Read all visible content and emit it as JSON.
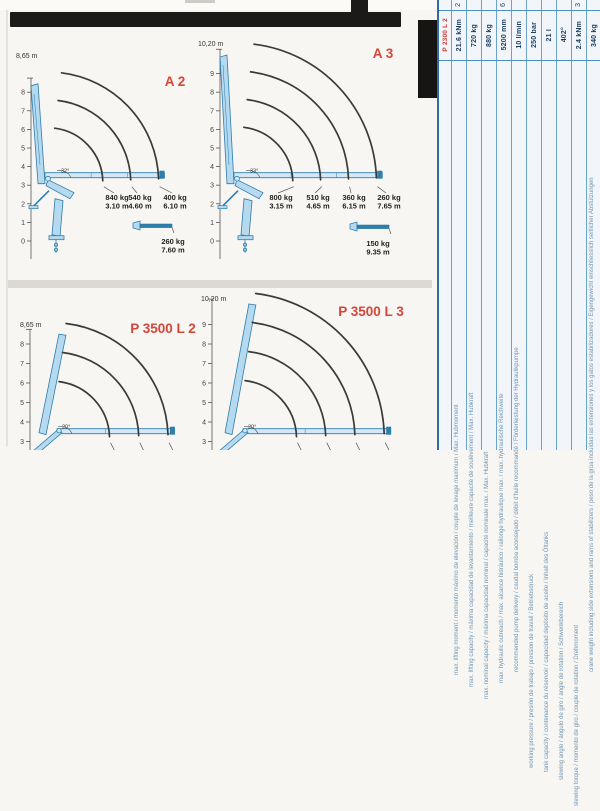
{
  "document": {
    "kind": "scanned crane load-diagram datasheet",
    "bg_color": "#f7f6f2"
  },
  "colors": {
    "arc": "#3a3a3a",
    "crane_fill": "#b5d9ee",
    "crane_fill_light": "#d3e8f4",
    "crane_stroke": "#2e7eae",
    "red": "#d6453a",
    "axis": "#555555",
    "load_text": "#1f1f1f",
    "table_line": "#4a90c4",
    "table_value": "#173b5e",
    "table_label": "#7096b6",
    "table_header_red": "#cc3a33"
  },
  "charts": [
    {
      "id": "a2",
      "type": "crane-load-diagram",
      "variant": "A",
      "title": "A 2",
      "max_height_label": "8,65 m",
      "y_ticks": [
        0,
        1,
        2,
        3,
        4,
        5,
        6,
        7,
        8
      ],
      "angle_label": "32°",
      "labels_visible": true,
      "loads": [
        {
          "load": "840 kg",
          "reach": "3.10 m",
          "reach_m": 3.1
        },
        {
          "load": "540 kg",
          "reach": "4.60 m",
          "reach_m": 4.6
        },
        {
          "load": "400 kg",
          "reach": "6.10 m",
          "reach_m": 6.1
        }
      ],
      "extension": {
        "load": "260 kg",
        "reach": "7.60 m"
      },
      "geom": {
        "axis_x": 31,
        "y0": 241,
        "unit": 18.6,
        "pivot_x": 48,
        "axis_top_m": 8.65,
        "title": {
          "x": 175,
          "y": 86
        },
        "top_label": {
          "x": 16,
          "y": 58
        },
        "label_row_y": 194,
        "label_centers": [
          117,
          140,
          175
        ],
        "ext_icon": {
          "x": 133,
          "y": 221
        },
        "ext_label": {
          "cx": 173,
          "y": 238
        }
      }
    },
    {
      "id": "a3",
      "type": "crane-load-diagram",
      "variant": "A",
      "title": "A 3",
      "max_height_label": "10,20 m",
      "y_ticks": [
        0,
        1,
        2,
        3,
        4,
        5,
        6,
        7,
        8,
        9
      ],
      "angle_label": "33°",
      "labels_visible": true,
      "loads": [
        {
          "load": "800 kg",
          "reach": "3.15 m",
          "reach_m": 3.15
        },
        {
          "load": "510 kg",
          "reach": "4.65 m",
          "reach_m": 4.65
        },
        {
          "load": "360 kg",
          "reach": "6.15 m",
          "reach_m": 6.15
        },
        {
          "load": "260 kg",
          "reach": "7.65 m",
          "reach_m": 7.65
        }
      ],
      "extension": {
        "load": "150 kg",
        "reach": "9.35 m"
      },
      "geom": {
        "axis_x": 220,
        "y0": 241,
        "unit": 18.6,
        "pivot_x": 237,
        "axis_top_m": 10.2,
        "title": {
          "x": 383,
          "y": 58
        },
        "top_label": {
          "x": 198,
          "y": 46
        },
        "label_row_y": 194,
        "label_centers": [
          281,
          318,
          354,
          389
        ],
        "ext_icon": {
          "x": 350,
          "y": 222
        },
        "ext_label": {
          "cx": 378,
          "y": 240
        }
      }
    },
    {
      "id": "p3500l2",
      "type": "crane-load-diagram",
      "variant": "P",
      "title": "P 3500 L 2",
      "max_height_label": "8,65 m",
      "y_ticks": [
        0,
        1,
        2,
        3,
        4,
        5,
        6,
        7,
        8
      ],
      "angle_label": "20°",
      "labels_visible": false,
      "loads": [],
      "arc_reaches_m": [
        3.1,
        4.6,
        6.1
      ],
      "geom": {
        "axis_x": 30,
        "y0": 500,
        "unit": 19.5,
        "pivot_x": 52,
        "axis_top_m": 8.65,
        "title": {
          "x": 163,
          "y": 333
        },
        "top_label": {
          "x": 20,
          "y": 327
        }
      }
    },
    {
      "id": "p3500l3",
      "type": "crane-load-diagram",
      "variant": "P",
      "title": "P 3500 L 3",
      "max_height_label": "10,20 m",
      "y_ticks": [
        0,
        1,
        2,
        3,
        4,
        5,
        6,
        7,
        8,
        9
      ],
      "angle_label": "20°",
      "labels_visible": false,
      "loads": [],
      "arc_reaches_m": [
        3.15,
        4.65,
        6.15,
        7.65
      ],
      "geom": {
        "axis_x": 212,
        "y0": 500,
        "unit": 19.5,
        "pivot_x": 238,
        "axis_top_m": 10.2,
        "title": {
          "x": 371,
          "y": 316
        },
        "top_label": {
          "x": 201,
          "y": 301
        }
      }
    }
  ],
  "spec_table": {
    "model_header": "P 2300 L 2",
    "columns": [
      {
        "value": "21.6 kNm",
        "partial_top": "2",
        "label_top": 155,
        "label": "max. lifting moment / momento máximo de elevación / couple de levage maximum / Max. Hubmoment"
      },
      {
        "value": "720 kg",
        "partial_top": "",
        "label_top": 167,
        "label": "max. lifting capacity / máxima capacidad de levantamiento / meilleure capacité de soulèvement / Max. Hubkraft"
      },
      {
        "value": "880 kg",
        "partial_top": "",
        "label_top": 179,
        "label": "max. nominal capacity / máxima capacidad nominal / capacité nominale max. / Max. Hubkraft"
      },
      {
        "value": "5200 mm",
        "partial_top": "6",
        "label_top": 163,
        "label": "max. hydraulic outreach / max. alcance hidráulico / rallonge hydraulique max. / max. hydraulische Reichweite"
      },
      {
        "value": "10 l/min",
        "partial_top": "",
        "label_top": 152,
        "label": "recommended pump delivery / caudal bomba aconsejado / débit d'huile recommandé / Förderleistung der Hydraulikpumpe"
      },
      {
        "value": "250 bar",
        "partial_top": "",
        "label_top": 248,
        "label": "working pressure / presión de trabajo / pression de travail / Betriebsdruck"
      },
      {
        "value": "21 l",
        "partial_top": "",
        "label_top": 252,
        "label": "tank capacity / contenance du réservoir / capacidad depósito de aceite / Inhalt des Öltanks"
      },
      {
        "value": "402°",
        "partial_top": "",
        "label_top": 260,
        "label": "slewing angle / ángulo de giro / angle de rotation / Schwenkbereich"
      },
      {
        "value": "2.4 kNm",
        "partial_top": "3",
        "label_top": 286,
        "label": "slewing torque / momento de giro / couple de rotation / Drehmoment"
      },
      {
        "value": "340 kg",
        "partial_top": "",
        "label_top": 152,
        "label": "crane weight including side extensions and rams of stabilizers / peso de la grúa incluidas las extensiones y los gatos estabilizadores / Eigengewicht einschliesslich seitlicher Abstützungen"
      }
    ]
  }
}
